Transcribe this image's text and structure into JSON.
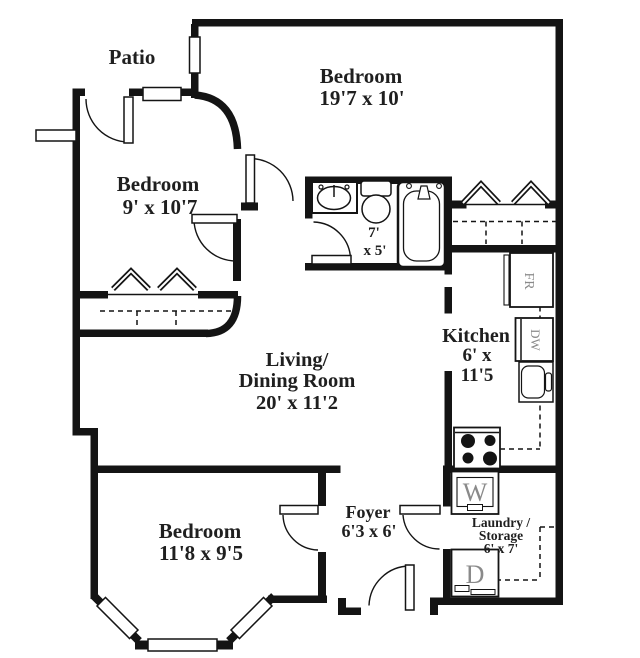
{
  "plan": {
    "type": "apartment-floor-plan",
    "colors": {
      "wall": "#141414",
      "background": "#ffffff",
      "label": "#1f1f1f",
      "appliance_label": "#8a8a8a"
    },
    "rooms": {
      "patio": {
        "label": "Patio"
      },
      "bedroom_top": {
        "label": "Bedroom",
        "dims": "19'7 x 10'"
      },
      "bedroom_left": {
        "label": "Bedroom",
        "dims": "9' x 10'7"
      },
      "bathroom": {
        "dims_line1": "7'",
        "dims_line2": "x 5'"
      },
      "kitchen": {
        "label": "Kitchen",
        "dims_line1": "6' x",
        "dims_line2": "11'5"
      },
      "living_dining": {
        "label_line1": "Living/",
        "label_line2": "Dining Room",
        "dims": "20' x 11'2"
      },
      "foyer": {
        "label": "Foyer",
        "dims": "6'3 x 6'"
      },
      "laundry": {
        "label_line1": "Laundry /",
        "label_line2": "Storage",
        "dims": "6' x 7'"
      },
      "bedroom_bottom": {
        "label": "Bedroom",
        "dims": "11'8 x 9'5"
      }
    },
    "appliances": {
      "fridge": "FR",
      "dishwasher": "DW",
      "washer": "W",
      "dryer": "D"
    }
  }
}
